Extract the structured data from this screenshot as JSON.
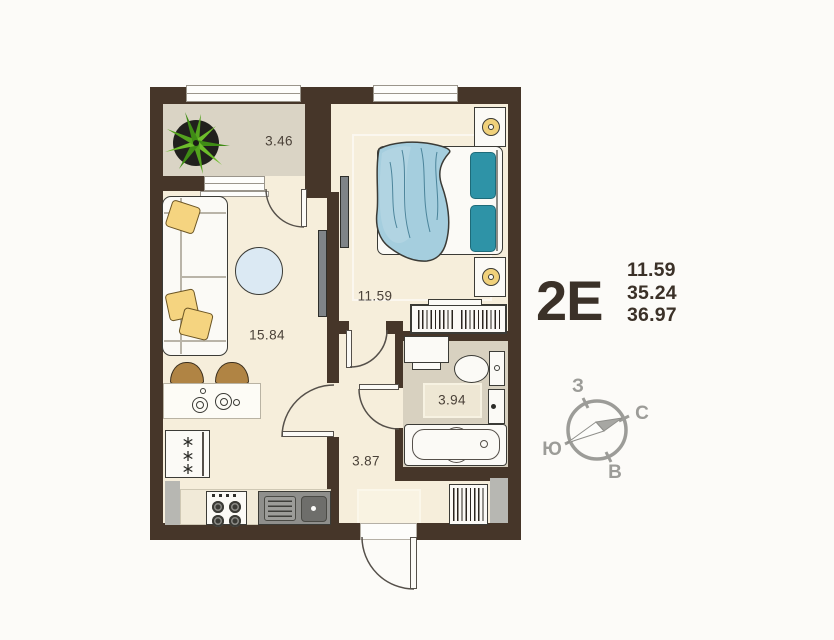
{
  "apartment": {
    "type_code": "2Е",
    "area_values": [
      "11.59",
      "35.24",
      "36.97"
    ]
  },
  "rooms": [
    {
      "id": "balcony",
      "area_label": "3.46"
    },
    {
      "id": "bedroom",
      "area_label": "11.59"
    },
    {
      "id": "living_kitchen",
      "area_label": "15.84"
    },
    {
      "id": "bathroom",
      "area_label": "3.94"
    },
    {
      "id": "hallway",
      "area_label": "3.87"
    }
  ],
  "compass": {
    "west": "З",
    "north": "С",
    "south": "Ю",
    "east": "В"
  },
  "colors": {
    "wall": "#463629",
    "floor": "#f6eedb",
    "balcony": "#dad4c5",
    "bath": "#d8d1c0",
    "blanket": "#a5cede",
    "pillow": "#2e93a7",
    "cushion": "#f5d480",
    "chair": "#b08444",
    "lamp": "#f0d17b",
    "ink": "#3b3128",
    "compass": "#9c9c98"
  }
}
